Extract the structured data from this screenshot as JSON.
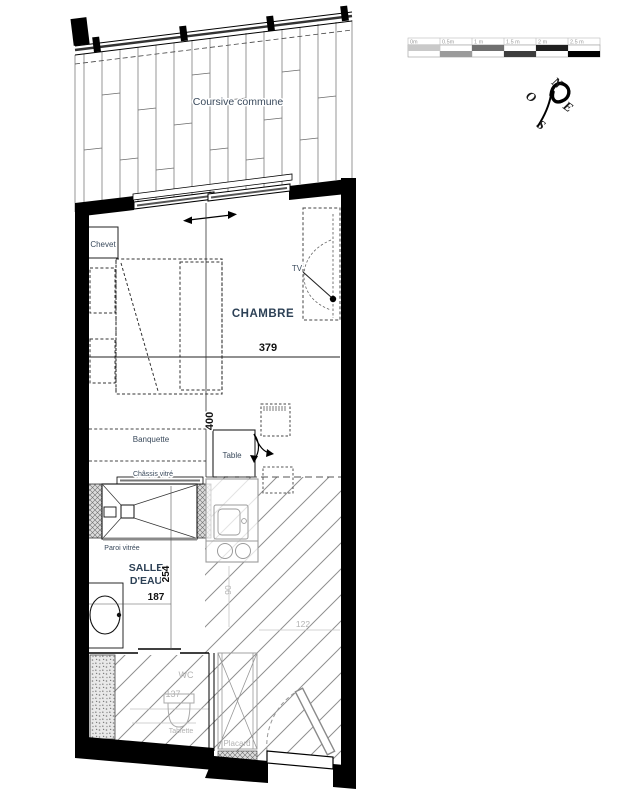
{
  "corridor_label": "Coursive commune",
  "scalebar": {
    "labels": [
      "0m",
      "0.5m",
      "1 m",
      "1.5 m",
      "2 m",
      "2.5 m"
    ]
  },
  "compass": {
    "north": "N",
    "east": "E",
    "south": "S",
    "west": "O"
  },
  "room_labels": {
    "chambre": "CHAMBRE",
    "salle_eau_line1": "SALLE",
    "salle_eau_line2": "D'EAU",
    "wc": "WC"
  },
  "annotations": {
    "chevet": "Chevet",
    "tv": "TV",
    "banquette": "Banquette",
    "table": "Table",
    "chassis_vitre": "Châssis vitré",
    "paroi_vitree": "Paroi vitrée",
    "tablette": "Tablette",
    "placard": "Placard"
  },
  "dimensions": {
    "chambre_width": "379",
    "chambre_depth": "400",
    "salle_eau_depth": "254",
    "salle_eau_width": "187",
    "wc_width": "137",
    "entry_width": "122",
    "kitchen_width": "90"
  },
  "colors": {
    "wall": "#000000",
    "label_navy": "#2d4156",
    "dimension_black": "#111111",
    "muted_gray": "#b3b3b3",
    "hatch_gray": "#8f8f8f"
  }
}
